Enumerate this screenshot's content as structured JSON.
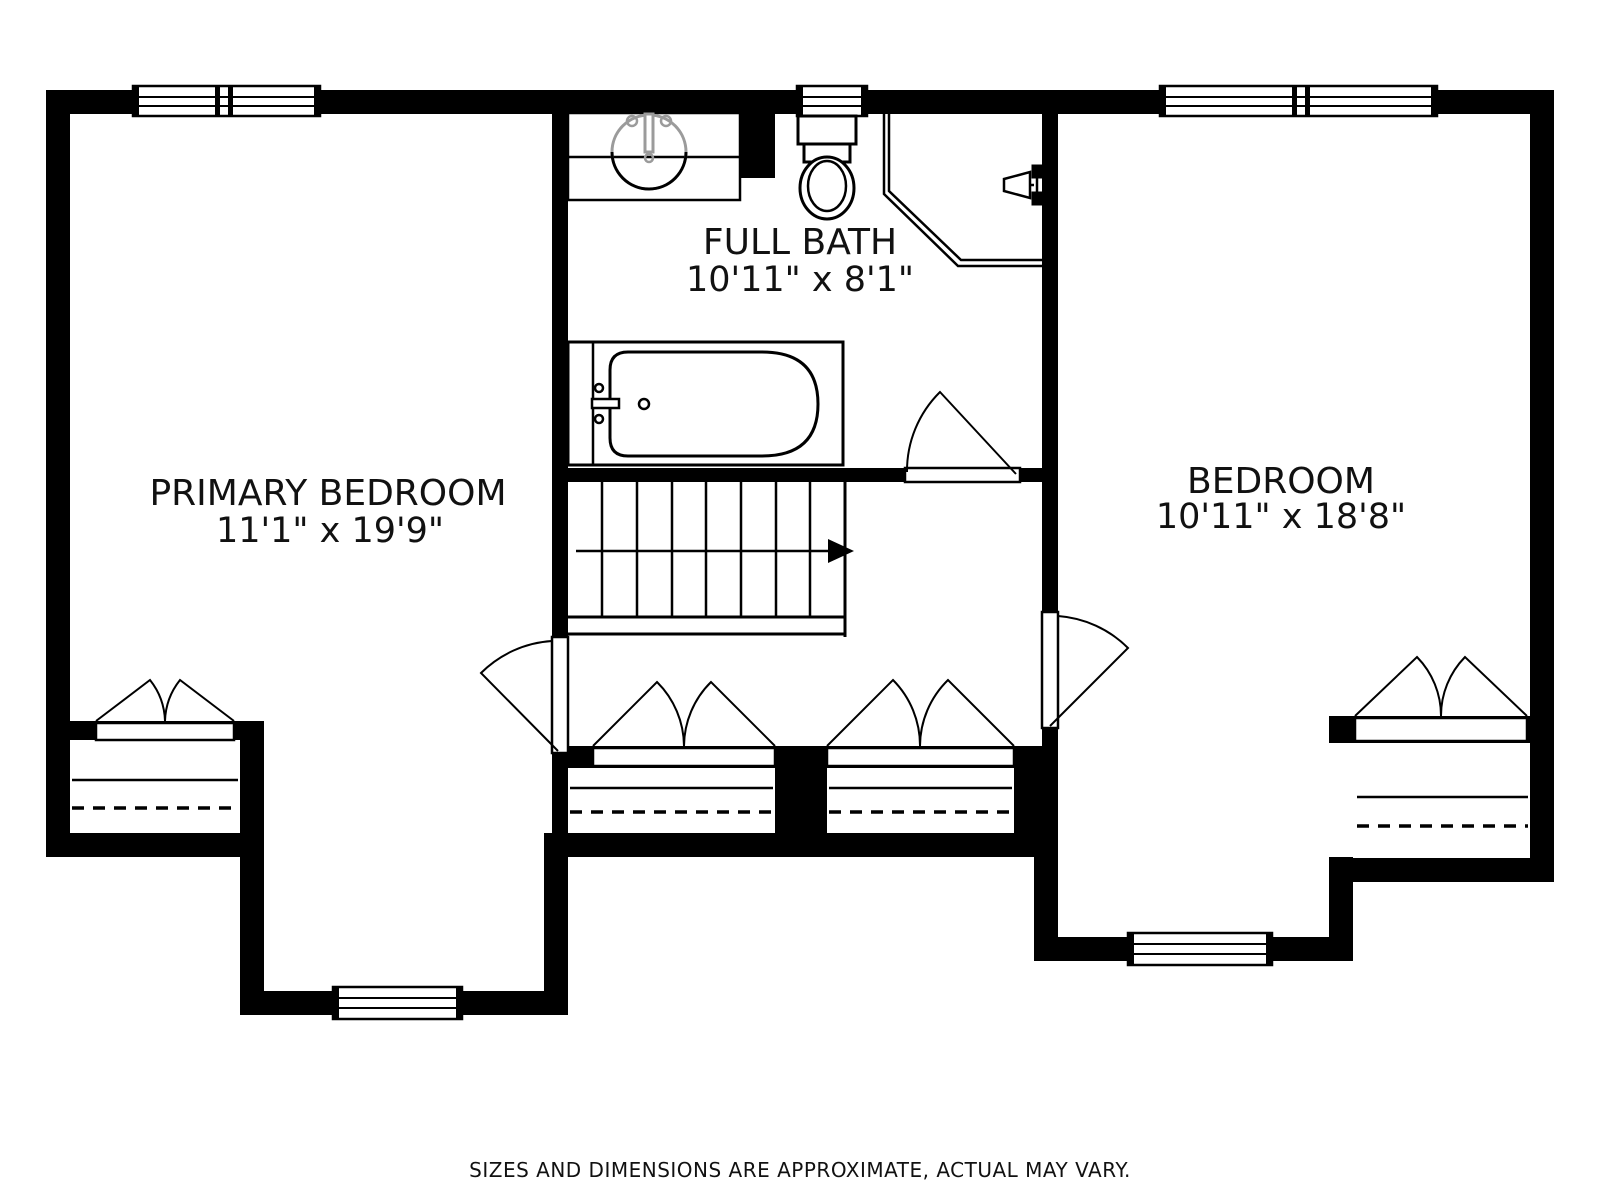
{
  "colors": {
    "wall": "#000000",
    "line": "#000000",
    "fixture_accent": "#9b9b9b",
    "disclaimer_text": "#a6a6a6",
    "background": "#ffffff"
  },
  "rooms": {
    "primary_bedroom": {
      "name": "PRIMARY BEDROOM",
      "dimensions": "11'1\" x 19'9\""
    },
    "full_bath": {
      "name": "FULL BATH",
      "dimensions": "10'11\" x 8'1\""
    },
    "bedroom": {
      "name": "BEDROOM",
      "dimensions": "10'11\" x 18'8\""
    }
  },
  "footer": {
    "disclaimer": "SIZES AND DIMENSIONS ARE APPROXIMATE, ACTUAL MAY VARY."
  },
  "icons": {
    "bathtub": "svg-shape",
    "sink-vanity": "svg-shape",
    "toilet": "svg-shape",
    "corner-shower": "svg-shape",
    "shower-head": "svg-shape",
    "stairs": "svg-shape",
    "stair-direction-arrow": "svg-shape",
    "bifold-closet-door": "svg-shape",
    "swing-door": "svg-shape",
    "window": "svg-shape"
  }
}
